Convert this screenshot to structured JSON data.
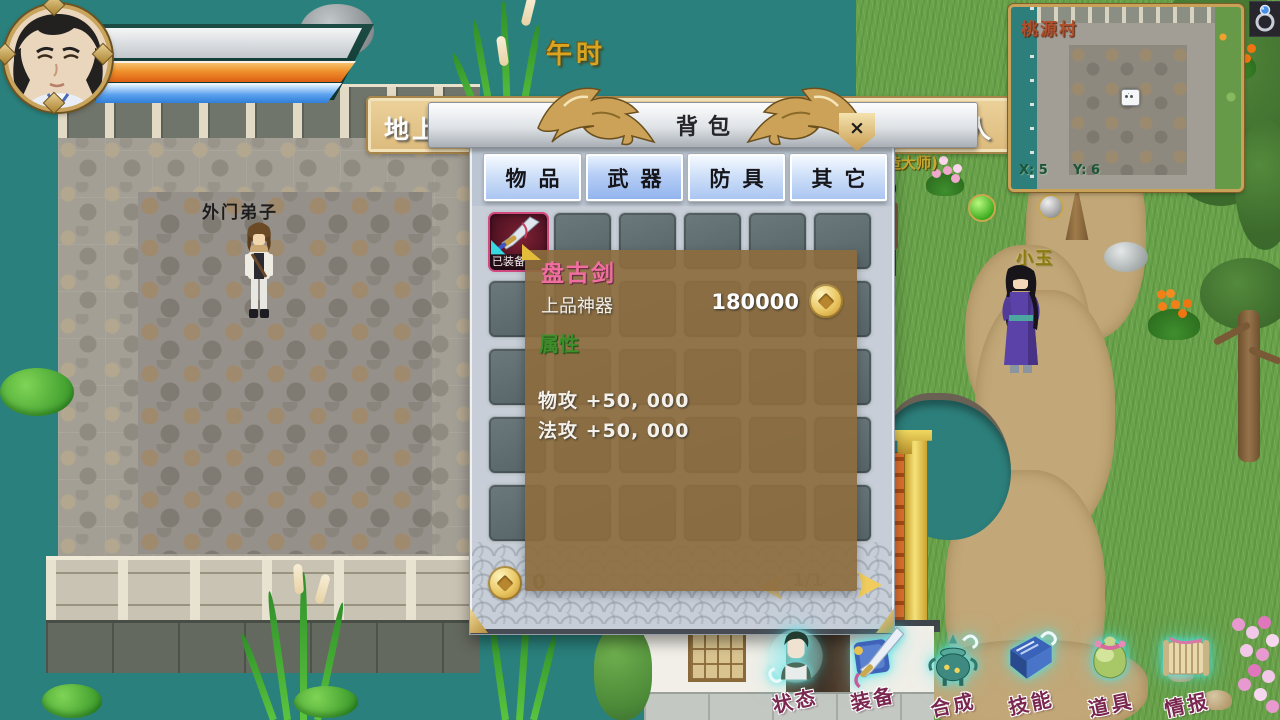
{
  "hud": {
    "time_label": "午时"
  },
  "marquee": {
    "left_text": "地上一群珍",
    "right_text": "有心上人"
  },
  "minimap": {
    "title": "桃源村",
    "coord_x": "X: 5",
    "coord_y": "Y: 6"
  },
  "world": {
    "npc_disciple": "外门弟子",
    "npc_xiaoyu": "小玉",
    "npc_smith": "造大师)"
  },
  "dialog": {
    "title": "背包",
    "close_label": "×",
    "tabs": [
      {
        "label": "物品"
      },
      {
        "label": "武器"
      },
      {
        "label": "防具"
      },
      {
        "label": "其它"
      }
    ],
    "active_tab": "武器",
    "grid": {
      "columns": 6,
      "rows": 5
    },
    "equipped_item": {
      "name": "盘古剑",
      "badge": "已装备"
    },
    "footer": {
      "coin_count": "0",
      "page": "1/1"
    }
  },
  "tooltip": {
    "name": "盘古剑",
    "grade": "上品神器",
    "price": "180000",
    "section_title": "属性",
    "attributes": [
      "物攻 +50, 000",
      "法攻 +50, 000"
    ]
  },
  "menu": {
    "items": [
      {
        "label": "状态"
      },
      {
        "label": "装备"
      },
      {
        "label": "合成"
      },
      {
        "label": "技能"
      },
      {
        "label": "道具"
      },
      {
        "label": "情报"
      }
    ]
  },
  "colors": {
    "accent_gold": "#cfa052",
    "hp_bar": "#ef8f2a",
    "mp_bar": "#5aa0ee",
    "tooltip_bg": "#8d6c3e",
    "item_name_pink": "#f06fa0",
    "attr_green": "#3e8f2c"
  }
}
